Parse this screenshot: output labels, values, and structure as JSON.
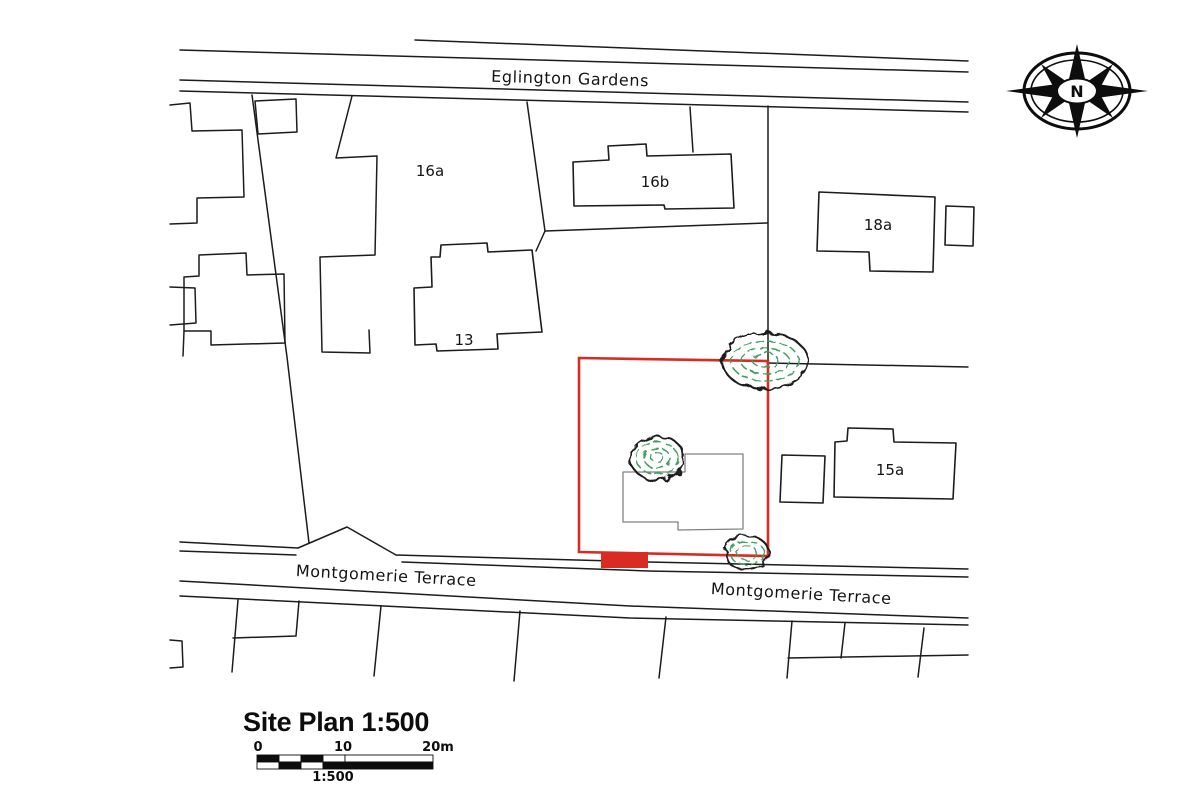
{
  "plan": {
    "title": "Site Plan 1:500",
    "streets": {
      "top": "Eglington Gardens",
      "bottom_left": "Montgomerie Terrace",
      "bottom_right": "Montgomerie Terrace"
    },
    "plots": {
      "b16a": "16a",
      "b16b": "16b",
      "b18a": "18a",
      "b13": "13",
      "b15a": "15a"
    },
    "compass_label": "N",
    "scale_bar": {
      "zero": "0",
      "ten": "10",
      "twenty": "20m",
      "ratio": "1:500"
    },
    "colors": {
      "site_boundary_red": "#d92b21",
      "tree_green": "#3f9e62",
      "line_black": "#1c1c1c",
      "building_gray": "#828282"
    }
  }
}
